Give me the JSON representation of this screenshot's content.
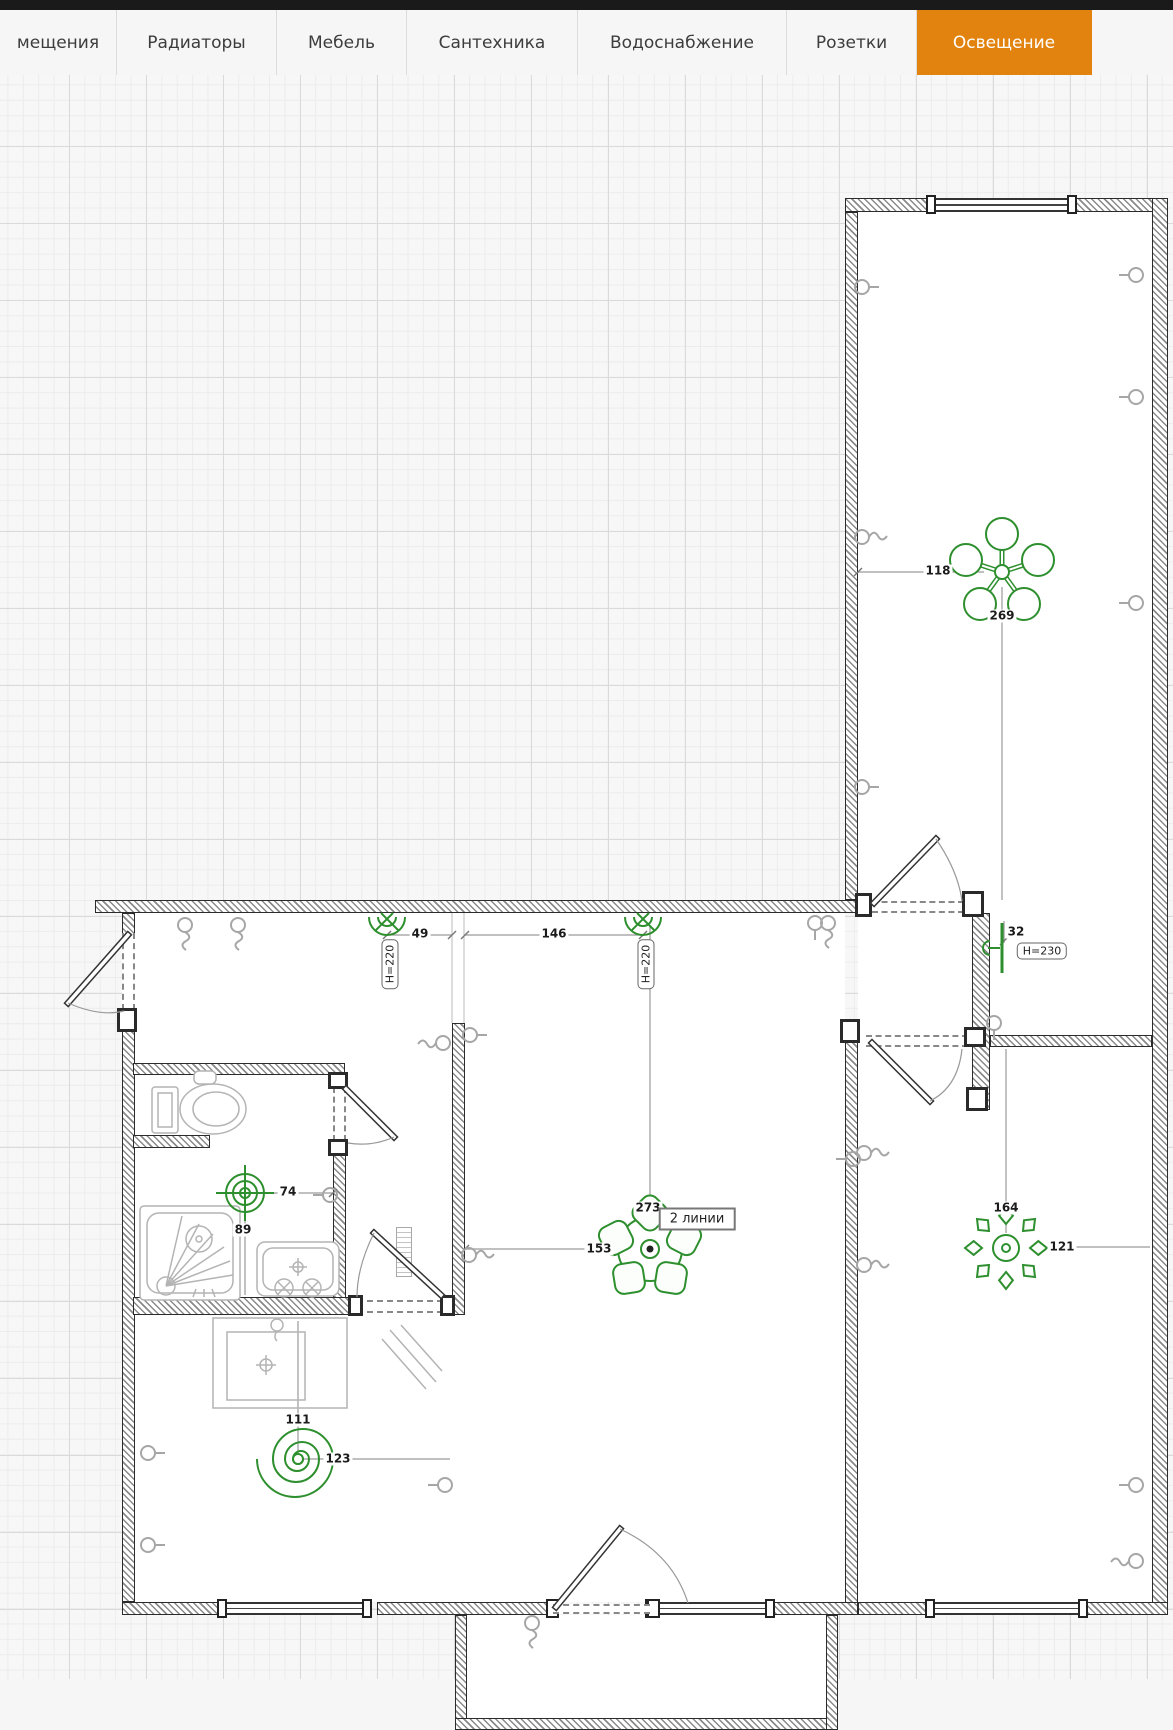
{
  "tabs": {
    "items": [
      {
        "label": "мещения",
        "active": false
      },
      {
        "label": "Радиаторы",
        "active": false
      },
      {
        "label": "Мебель",
        "active": false
      },
      {
        "label": "Сантехника",
        "active": false
      },
      {
        "label": "Водоснабжение",
        "active": false
      },
      {
        "label": "Розетки",
        "active": false
      },
      {
        "label": "Освещение",
        "active": true
      }
    ]
  },
  "plan": {
    "dims": {
      "d118": "118",
      "d269": "269",
      "d49": "49",
      "d146": "146",
      "d32": "32",
      "d74": "74",
      "d89": "89",
      "d273": "273",
      "d153": "153",
      "d111": "111",
      "d123": "123",
      "d164": "164",
      "d121": "121"
    },
    "badges": {
      "h220": "H=220",
      "h230": "H=230",
      "two_lines": "2 линии"
    },
    "colors": {
      "accent_tab": "#e2830f",
      "fixture_green": "#2e8f2e",
      "symbol_gray": "#a6a6a6"
    },
    "fixtures": [
      {
        "name": "chandelier-5-bulb",
        "dims": [
          "118",
          "269"
        ]
      },
      {
        "name": "wall-sconce-1",
        "dims": [
          "49"
        ],
        "height": "H=220"
      },
      {
        "name": "wall-sconce-2",
        "dims": [
          "146"
        ],
        "height": "H=220"
      },
      {
        "name": "wall-light",
        "dims": [
          "32"
        ],
        "height": "H=230"
      },
      {
        "name": "ceiling-spot",
        "dims": [
          "74",
          "89"
        ]
      },
      {
        "name": "chandelier-5-shade",
        "dims": [
          "273",
          "153"
        ],
        "note": "2 линии"
      },
      {
        "name": "spiral-pendant",
        "dims": [
          "111",
          "123"
        ]
      },
      {
        "name": "fixture-8-petal",
        "dims": [
          "164",
          "121"
        ]
      }
    ]
  }
}
